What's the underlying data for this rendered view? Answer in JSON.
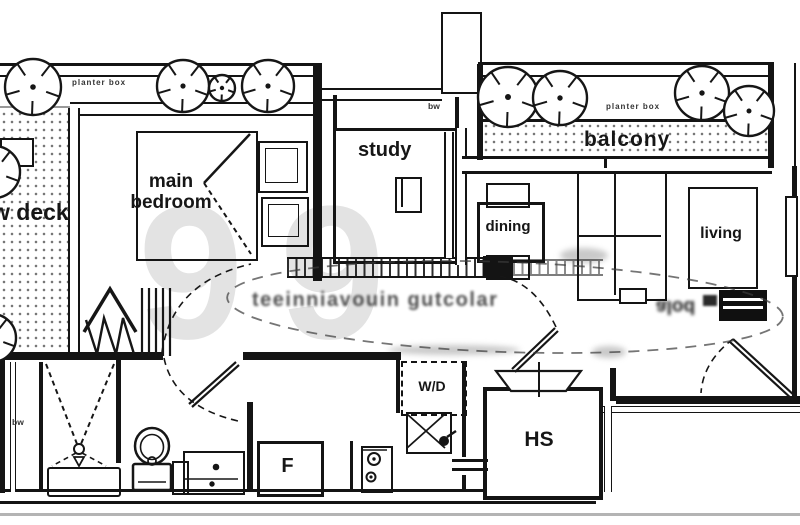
{
  "title": "apartment floor plan",
  "watermark": {
    "big": "99",
    "stamp": "teeinniavouin gutcolar",
    "tv_note": "alod"
  },
  "rooms": {
    "deck": {
      "label": "w deck"
    },
    "main_bedroom": {
      "label": "main bedroom"
    },
    "study": {
      "label": "study"
    },
    "balcony": {
      "label": "balcony"
    },
    "dining": {
      "label": "dining"
    },
    "living": {
      "label": "living"
    },
    "household_shelter": {
      "label": "HS"
    }
  },
  "fixtures": {
    "washer_dryer": "W/D",
    "fridge": "F"
  },
  "annotations": {
    "planter_box_left": "planter box",
    "planter_box_right": "planter box",
    "bay_window_top": "bw",
    "bay_window_left": "bw"
  },
  "icons": {
    "tree": "plant-top-icon",
    "bed": "bed-icon",
    "wardrobe": "wardrobe-hangers-icon",
    "toilet": "toilet-icon",
    "shower": "shower-icon",
    "sink": "kitchen-sink-icon",
    "hob": "hob-icon",
    "sofa": "sofa-icon",
    "tv": "tv-console-icon",
    "door": "door-swing-icon"
  },
  "colors": {
    "line": "#141414",
    "wm": "#e3e3e3",
    "stamp": "#303030",
    "rule": "#b4b4b4",
    "dots": "#777777"
  }
}
